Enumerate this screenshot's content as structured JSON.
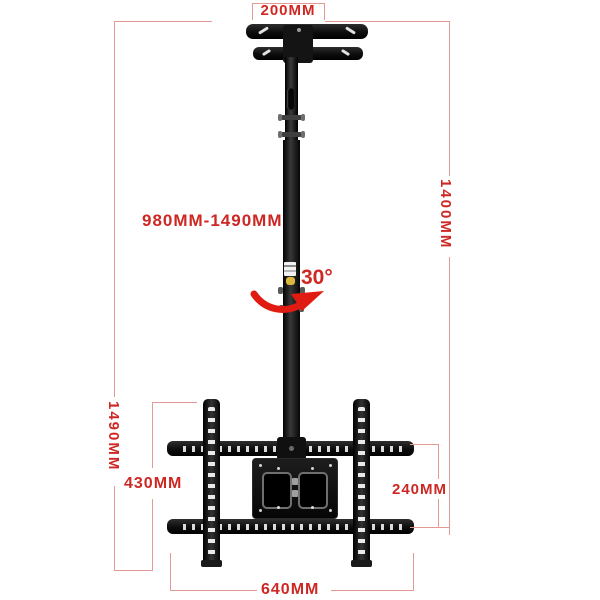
{
  "diagram": {
    "subject": "ceiling-tv-mount-dimension-diagram",
    "colors": {
      "dimension_text": "#cd2824",
      "dimension_line": "#e39a94",
      "rotation_arrow": "#e01b12",
      "mount_black": "#141414",
      "knob_yellow": "#ddb83e",
      "background": "#ffffff"
    },
    "dimensions": {
      "ceiling_plate_width": "200MM",
      "pole_height_range": "980MM-1490MM",
      "overall_drop_right": "1400MM",
      "swivel_angle": "30°",
      "overall_drop_left": "1490MM",
      "vesa_arm_height": "430MM",
      "rail_spacing": "240MM",
      "rail_width": "640MM"
    }
  }
}
